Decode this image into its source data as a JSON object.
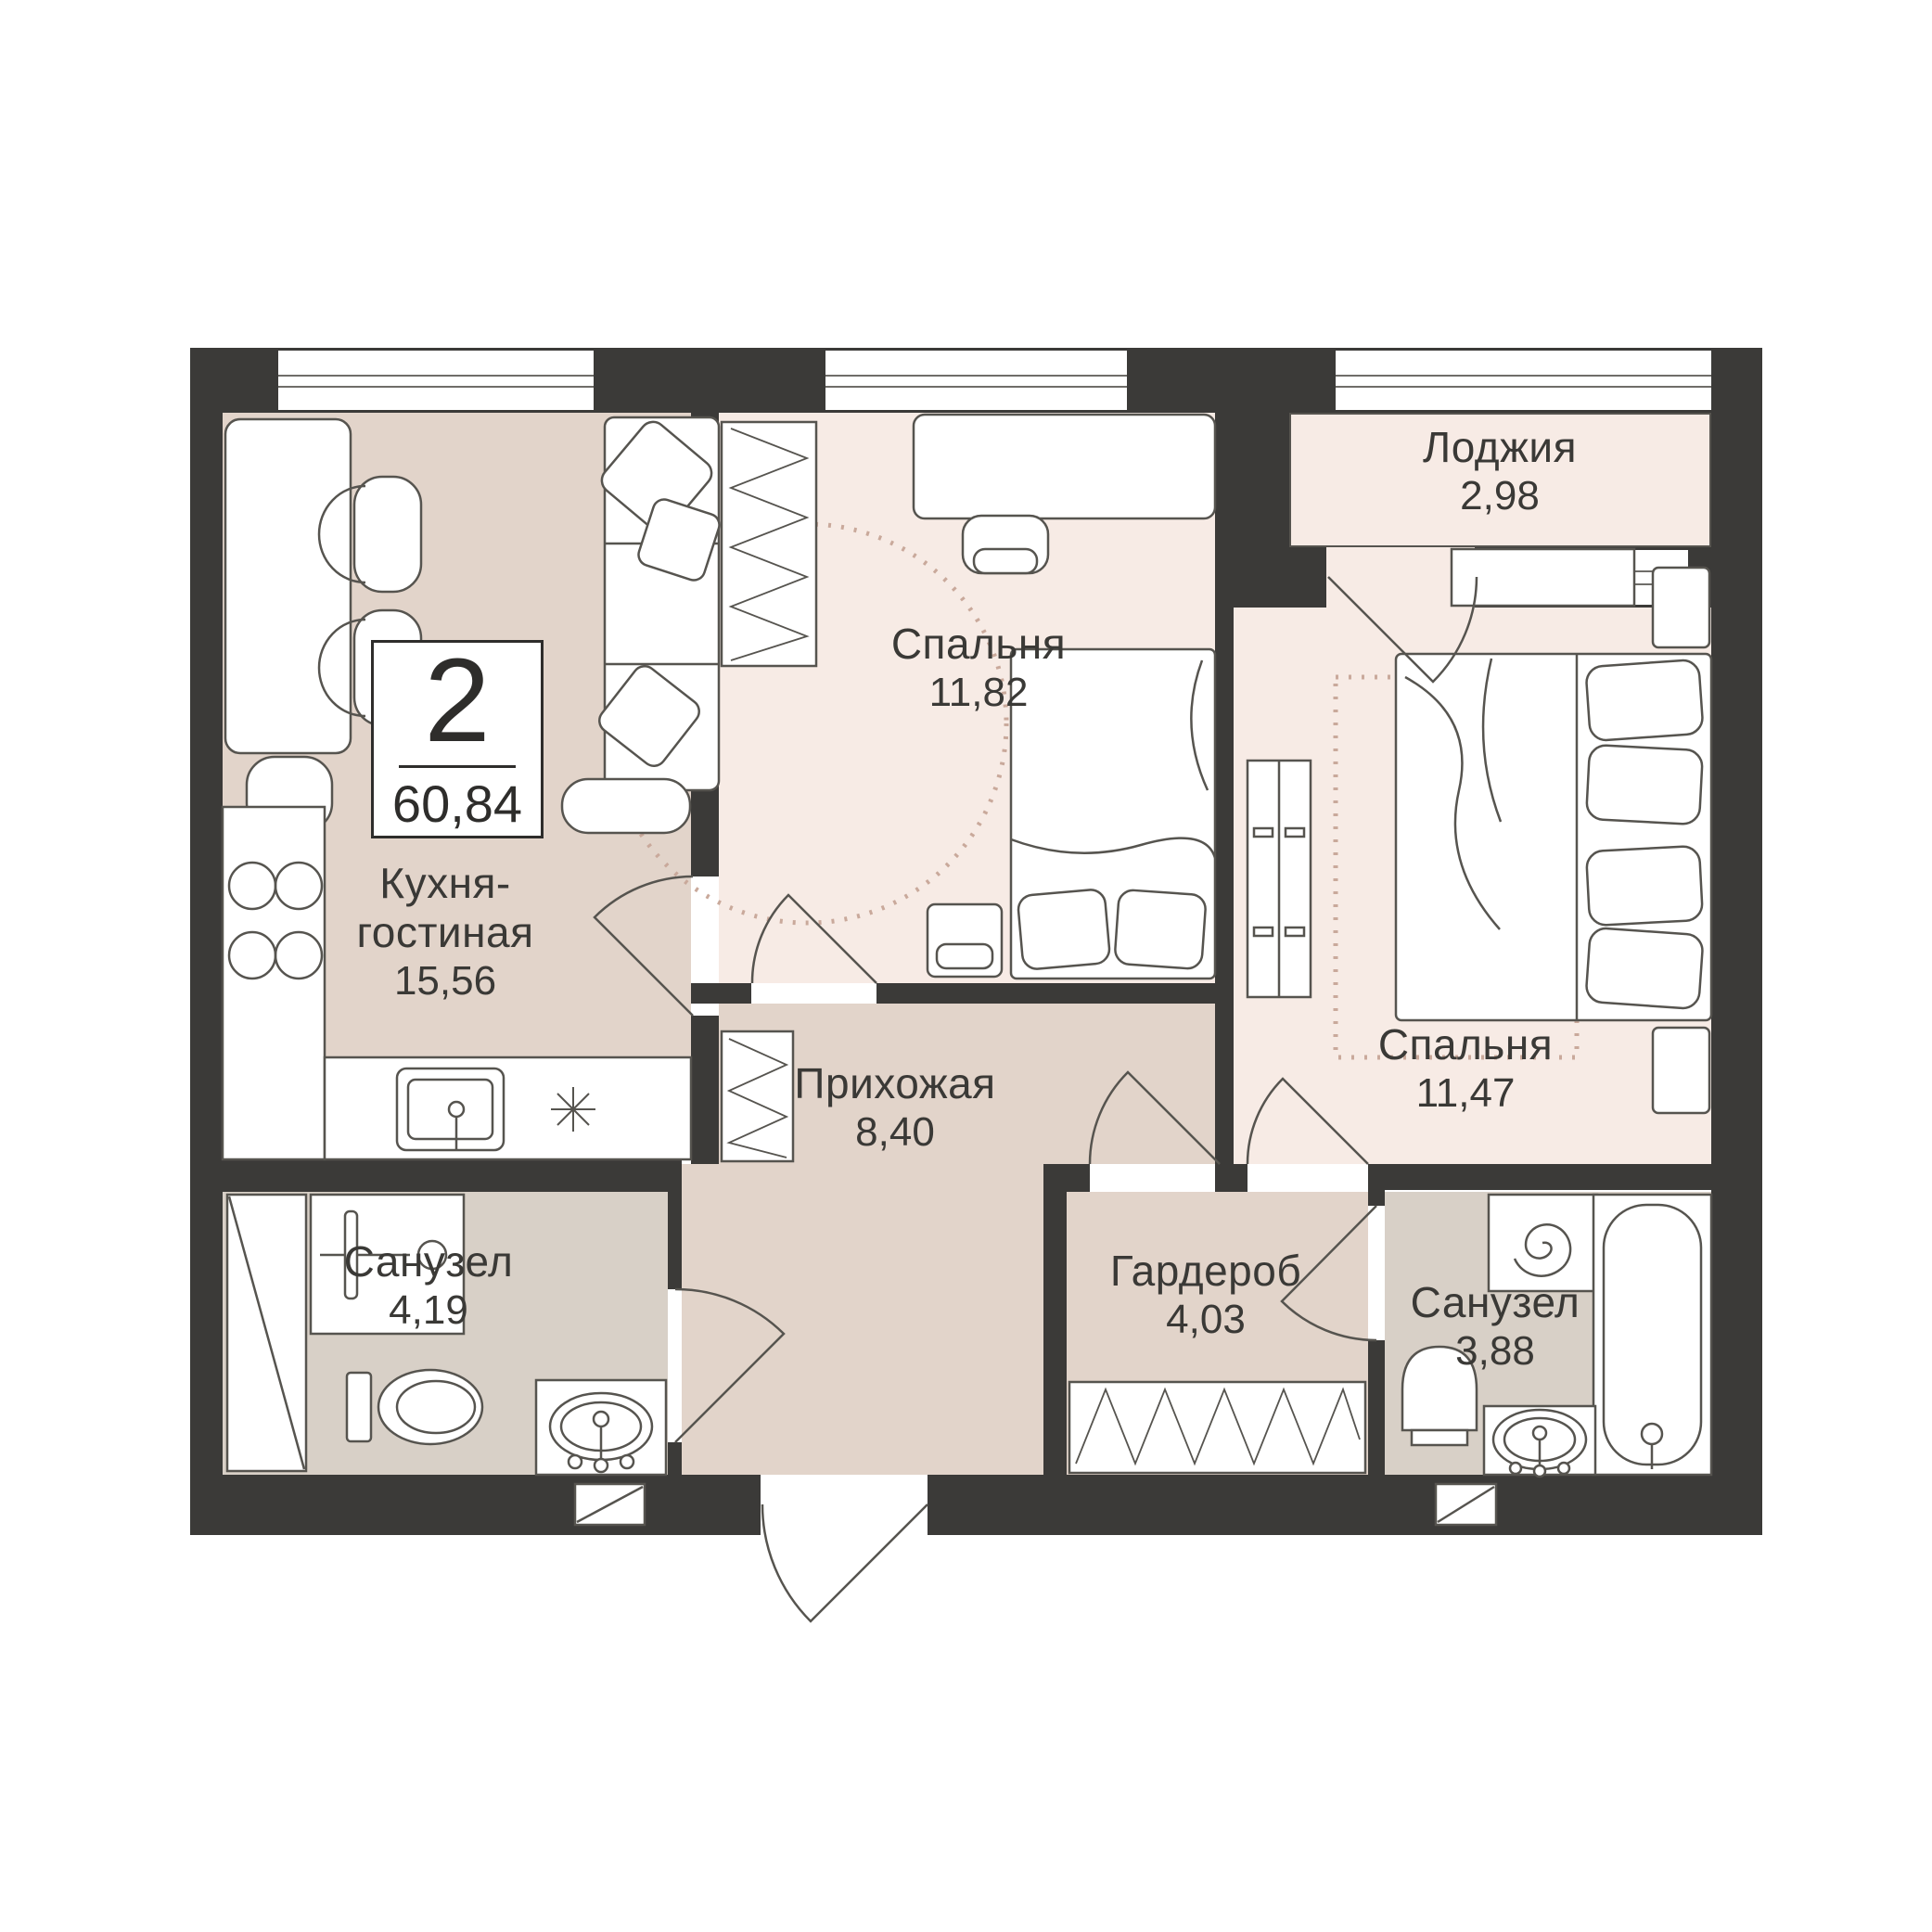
{
  "unit": {
    "rooms_count": "2",
    "total_area": "60,84"
  },
  "rooms": {
    "kitchen_living": {
      "name_line1": "Кухня-",
      "name_line2": "гостиная",
      "area": "15,56"
    },
    "bedroom1": {
      "name": "Спальня",
      "area": "11,82"
    },
    "bedroom2": {
      "name": "Спальня",
      "area": "11,47"
    },
    "loggia": {
      "name": "Лоджия",
      "area": "2,98"
    },
    "hallway": {
      "name": "Прихожая",
      "area": "8,40"
    },
    "bathroom1": {
      "name": "Санузел",
      "area": "4,19"
    },
    "wardrobe": {
      "name": "Гардероб",
      "area": "4,03"
    },
    "bathroom2": {
      "name": "Санузел",
      "area": "3,88"
    }
  },
  "icons": {
    "hob": "four-burner-circles",
    "washing_machine": "spiral",
    "ventilation": "box-with-diagonal",
    "kitchen_appliance": "asterisk-snowflake"
  },
  "colors": {
    "wall": "#3b3a38",
    "floor_main": "#e2d4ca",
    "floor_bedroom": "#f7ebe5",
    "floor_bathroom": "#d8d0c7",
    "furniture_line": "#56544f",
    "rug_dots": "#c9a99b",
    "text": "#3a3936",
    "background": "#ffffff"
  }
}
